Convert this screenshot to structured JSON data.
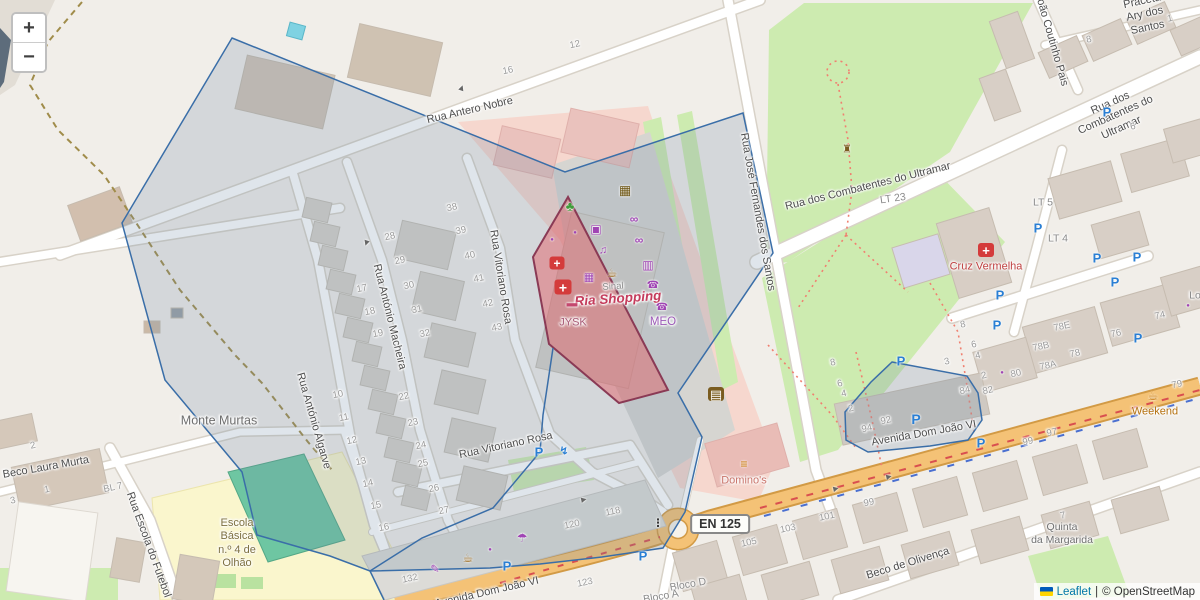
{
  "controls": {
    "zoom_in": "+",
    "zoom_out": "−"
  },
  "attribution": {
    "leaflet": "Leaflet",
    "sep": "|",
    "copyright": "© OpenStreetMap"
  },
  "en125": "EN 125",
  "colors": {
    "land": "#f1eee9",
    "road_orange": "#f4c276",
    "road_casing": "#d8d2c8",
    "green": "#cdebb0",
    "overlay_stroke": "#3a6ea8",
    "overlay_fill": "rgba(110,135,165,0.22)",
    "highlight_stroke": "#8a3a55",
    "highlight_fill": "rgba(226,100,106,0.5)",
    "shop_purple": "#a044b4",
    "health_red": "#d43b3b",
    "parking_blue": "#2a7fd4",
    "amenity_brown": "#9c6a1e"
  },
  "street_labels": [
    {
      "text": "Rua Antero Nobre",
      "x": 470,
      "y": 111,
      "r": -13,
      "s": 11
    },
    {
      "text": "Rua Vitoriano Rosa",
      "x": 500,
      "y": 277,
      "r": 81,
      "s": 11
    },
    {
      "text": "Rua Vitoriano Rosa",
      "x": 506,
      "y": 446,
      "r": -12,
      "s": 11
    },
    {
      "text": "Rua António Macheira",
      "x": 389,
      "y": 317,
      "r": 76,
      "s": 11
    },
    {
      "text": "Rua António Algarve",
      "x": 313,
      "y": 421,
      "r": 74,
      "s": 11
    },
    {
      "text": "Rua José Fernandes dos Santos",
      "x": 757,
      "y": 212,
      "r": 80,
      "s": 11
    },
    {
      "text": "Rua dos Combatentes do Ultramar",
      "x": 868,
      "y": 187,
      "r": -14,
      "s": 11
    },
    {
      "text": "Rua dos Combatentes do Ultramar",
      "x": 1116,
      "y": 116,
      "r": -24,
      "s": 11
    },
    {
      "text": "Praceta Ary dos Santos",
      "x": 1145,
      "y": 15,
      "r": -12,
      "s": 11
    },
    {
      "text": "João Coutinho Pais",
      "x": 1051,
      "y": 40,
      "r": 74,
      "s": 11
    },
    {
      "text": "Avenida Dom João VI",
      "x": 924,
      "y": 434,
      "r": -10,
      "s": 11
    },
    {
      "text": "Avenida Dom João VI",
      "x": 487,
      "y": 593,
      "r": -13,
      "s": 11
    },
    {
      "text": "Beco de Olivença",
      "x": 908,
      "y": 564,
      "r": -17,
      "s": 11
    },
    {
      "text": "Beco Laura Murta",
      "x": 46,
      "y": 468,
      "r": -10,
      "s": 11
    },
    {
      "text": "Rua Escola do Futebol",
      "x": 148,
      "y": 545,
      "r": 70,
      "s": 11
    }
  ],
  "place_labels": [
    {
      "text": "Monte Murtas",
      "x": 219,
      "y": 421,
      "r": 0,
      "s": 12.5,
      "c": "#6e6e6e"
    },
    {
      "text": "Ria Shopping",
      "x": 618,
      "y": 299,
      "r": -4,
      "s": 13.5,
      "c": "#c43c5c",
      "b": true,
      "i": true
    },
    {
      "text": "Sinal",
      "x": 613,
      "y": 287,
      "r": -4,
      "s": 9.5,
      "c": "#8a8a8a"
    },
    {
      "text": "JYSK",
      "x": 573,
      "y": 323,
      "r": 0,
      "s": 11,
      "c": "#a85a75"
    },
    {
      "text": "MEO",
      "x": 663,
      "y": 322,
      "r": 0,
      "s": 11.5,
      "c": "#9b59b6"
    },
    {
      "text": "Cruz Vermelha",
      "x": 986,
      "y": 267,
      "r": 0,
      "s": 11,
      "c": "#bf4040"
    },
    {
      "text": "Domino's",
      "x": 744,
      "y": 481,
      "r": 0,
      "s": 11,
      "c": "#c9756b"
    },
    {
      "text": "Weekend",
      "x": 1155,
      "y": 412,
      "r": 0,
      "s": 11,
      "c": "#b5710f"
    },
    {
      "text": "Escola\nBásica\nn.º 4 de\nOlhão",
      "x": 237,
      "y": 544,
      "r": 0,
      "s": 11,
      "c": "#7d7040"
    },
    {
      "text": "Quinta\nda Margarida",
      "x": 1062,
      "y": 534,
      "r": 0,
      "s": 10.5,
      "c": "#707070"
    },
    {
      "text": "Bloco D",
      "x": 688,
      "y": 585,
      "r": -10,
      "s": 10.5,
      "c": "#8a8a8a"
    },
    {
      "text": "Bloco A",
      "x": 661,
      "y": 597,
      "r": -10,
      "s": 10.5,
      "c": "#8a8a8a"
    },
    {
      "text": "LT 5",
      "x": 1043,
      "y": 203,
      "r": 0,
      "s": 10.5,
      "c": "#8a8a8a"
    },
    {
      "text": "LT 4",
      "x": 1058,
      "y": 239,
      "r": 0,
      "s": 10.5,
      "c": "#8a8a8a"
    },
    {
      "text": "LT 23",
      "x": 893,
      "y": 199,
      "r": -8,
      "s": 10.5,
      "c": "#8a8a8a"
    },
    {
      "text": "Lo",
      "x": 1195,
      "y": 296,
      "r": 0,
      "s": 10.5,
      "c": "#8a8a8a"
    }
  ],
  "house_numbers": [
    {
      "t": "10",
      "x": 338,
      "y": 395
    },
    {
      "t": "11",
      "x": 344,
      "y": 418
    },
    {
      "t": "12",
      "x": 352,
      "y": 441
    },
    {
      "t": "13",
      "x": 361,
      "y": 462
    },
    {
      "t": "14",
      "x": 368,
      "y": 484
    },
    {
      "t": "15",
      "x": 376,
      "y": 506
    },
    {
      "t": "16",
      "x": 384,
      "y": 528
    },
    {
      "t": "17",
      "x": 362,
      "y": 289
    },
    {
      "t": "18",
      "x": 370,
      "y": 312
    },
    {
      "t": "19",
      "x": 378,
      "y": 334
    },
    {
      "t": "22",
      "x": 404,
      "y": 397
    },
    {
      "t": "23",
      "x": 413,
      "y": 423
    },
    {
      "t": "24",
      "x": 421,
      "y": 446
    },
    {
      "t": "25",
      "x": 423,
      "y": 464
    },
    {
      "t": "26",
      "x": 434,
      "y": 489
    },
    {
      "t": "27",
      "x": 444,
      "y": 511
    },
    {
      "t": "28",
      "x": 390,
      "y": 237
    },
    {
      "t": "29",
      "x": 400,
      "y": 261
    },
    {
      "t": "30",
      "x": 409,
      "y": 286
    },
    {
      "t": "31",
      "x": 417,
      "y": 310
    },
    {
      "t": "32",
      "x": 425,
      "y": 334
    },
    {
      "t": "38",
      "x": 452,
      "y": 208
    },
    {
      "t": "39",
      "x": 461,
      "y": 231
    },
    {
      "t": "40",
      "x": 470,
      "y": 256
    },
    {
      "t": "41",
      "x": 479,
      "y": 279
    },
    {
      "t": "42",
      "x": 488,
      "y": 304
    },
    {
      "t": "43",
      "x": 497,
      "y": 328
    },
    {
      "t": "16",
      "x": 508,
      "y": 71
    },
    {
      "t": "12",
      "x": 575,
      "y": 45
    },
    {
      "t": "118",
      "x": 613,
      "y": 512
    },
    {
      "t": "120",
      "x": 572,
      "y": 525
    },
    {
      "t": "132",
      "x": 410,
      "y": 579
    },
    {
      "t": "123",
      "x": 585,
      "y": 583
    },
    {
      "t": "105",
      "x": 749,
      "y": 543
    },
    {
      "t": "103",
      "x": 788,
      "y": 529
    },
    {
      "t": "101",
      "x": 827,
      "y": 517
    },
    {
      "t": "99",
      "x": 869,
      "y": 503
    },
    {
      "t": "99",
      "x": 1028,
      "y": 442
    },
    {
      "t": "97",
      "x": 1052,
      "y": 433
    },
    {
      "t": "79",
      "x": 1177,
      "y": 385
    },
    {
      "t": "7",
      "x": 1063,
      "y": 516
    },
    {
      "t": "74",
      "x": 1160,
      "y": 316
    },
    {
      "t": "76",
      "x": 1116,
      "y": 334
    },
    {
      "t": "78E",
      "x": 1062,
      "y": 327
    },
    {
      "t": "78B",
      "x": 1041,
      "y": 347
    },
    {
      "t": "78",
      "x": 1075,
      "y": 354
    },
    {
      "t": "78A",
      "x": 1048,
      "y": 366
    },
    {
      "t": "80",
      "x": 1016,
      "y": 374
    },
    {
      "t": "82",
      "x": 988,
      "y": 391
    },
    {
      "t": "84",
      "x": 965,
      "y": 391
    },
    {
      "t": "92",
      "x": 886,
      "y": 421
    },
    {
      "t": "94",
      "x": 867,
      "y": 429
    },
    {
      "t": "8",
      "x": 963,
      "y": 325
    },
    {
      "t": "6",
      "x": 974,
      "y": 345
    },
    {
      "t": "4",
      "x": 978,
      "y": 356
    },
    {
      "t": "2",
      "x": 984,
      "y": 376
    },
    {
      "t": "3",
      "x": 947,
      "y": 362
    },
    {
      "t": "8",
      "x": 833,
      "y": 363
    },
    {
      "t": "6",
      "x": 840,
      "y": 384
    },
    {
      "t": "4",
      "x": 844,
      "y": 394
    },
    {
      "t": "2",
      "x": 851,
      "y": 409
    },
    {
      "t": "8",
      "x": 1089,
      "y": 40
    },
    {
      "t": "1",
      "x": 1170,
      "y": 19
    },
    {
      "t": "6",
      "x": 1133,
      "y": 127
    },
    {
      "t": "BL 7",
      "x": 113,
      "y": 488
    },
    {
      "t": "3",
      "x": 13,
      "y": 501
    },
    {
      "t": "1",
      "x": 47,
      "y": 490
    },
    {
      "t": "2",
      "x": 33,
      "y": 446
    }
  ],
  "pois": [
    {
      "name": "parking-icon",
      "g": "P",
      "x": 1107,
      "y": 112,
      "c": "#2a7fd4",
      "s": 13,
      "b": true
    },
    {
      "name": "parking-icon",
      "g": "P",
      "x": 1038,
      "y": 228,
      "c": "#2a7fd4",
      "s": 13,
      "b": true
    },
    {
      "name": "parking-icon",
      "g": "P",
      "x": 1097,
      "y": 258,
      "c": "#2a7fd4",
      "s": 13,
      "b": true
    },
    {
      "name": "parking-icon",
      "g": "P",
      "x": 1137,
      "y": 257,
      "c": "#2a7fd4",
      "s": 13,
      "b": true
    },
    {
      "name": "parking-icon",
      "g": "P",
      "x": 1115,
      "y": 282,
      "c": "#2a7fd4",
      "s": 13,
      "b": true
    },
    {
      "name": "parking-icon",
      "g": "P",
      "x": 1000,
      "y": 295,
      "c": "#2a7fd4",
      "s": 13,
      "b": true
    },
    {
      "name": "parking-icon",
      "g": "P",
      "x": 997,
      "y": 325,
      "c": "#2a7fd4",
      "s": 13,
      "b": true
    },
    {
      "name": "parking-icon",
      "g": "P",
      "x": 1138,
      "y": 338,
      "c": "#2a7fd4",
      "s": 13,
      "b": true
    },
    {
      "name": "parking-icon",
      "g": "P",
      "x": 901,
      "y": 361,
      "c": "#2a7fd4",
      "s": 13,
      "b": true
    },
    {
      "name": "parking-icon",
      "g": "P",
      "x": 916,
      "y": 419,
      "c": "#2a7fd4",
      "s": 14,
      "b": true
    },
    {
      "name": "parking-icon",
      "g": "P",
      "x": 981,
      "y": 443,
      "c": "#2a7fd4",
      "s": 13,
      "b": true
    },
    {
      "name": "parking-icon",
      "g": "P",
      "x": 539,
      "y": 452,
      "c": "#2a7fd4",
      "s": 13,
      "b": true
    },
    {
      "name": "parking-icon",
      "g": "P",
      "x": 507,
      "y": 566,
      "c": "#2a7fd4",
      "s": 13,
      "b": true
    },
    {
      "name": "parking-icon",
      "g": "P",
      "x": 643,
      "y": 556,
      "c": "#2a7fd4",
      "s": 13,
      "b": true
    },
    {
      "name": "charging-station-icon",
      "g": "↯",
      "x": 564,
      "y": 452,
      "c": "#2a7fd4",
      "s": 11,
      "b": true
    },
    {
      "name": "cinema-icon",
      "g": "▦",
      "x": 625,
      "y": 190,
      "c": "#6b5310",
      "s": 13
    },
    {
      "name": "tree-icon",
      "g": "♣",
      "x": 570,
      "y": 206,
      "c": "#3f9c3a",
      "s": 13
    },
    {
      "name": "tv-shop-icon",
      "g": "▣",
      "x": 596,
      "y": 229,
      "c": "#a044b4",
      "s": 12
    },
    {
      "name": "optician-icon",
      "g": "∞",
      "x": 634,
      "y": 219,
      "c": "#a044b4",
      "s": 12,
      "b": true
    },
    {
      "name": "optician-icon",
      "g": "∞",
      "x": 639,
      "y": 240,
      "c": "#a044b4",
      "s": 12,
      "b": true
    },
    {
      "name": "music-shop-icon",
      "g": "♫",
      "x": 603,
      "y": 251,
      "c": "#a044b4",
      "s": 11
    },
    {
      "name": "electronics-shop-icon",
      "g": "▦",
      "x": 589,
      "y": 278,
      "c": "#a044b4",
      "s": 11
    },
    {
      "name": "cafe-icon",
      "g": "☕",
      "x": 612,
      "y": 273,
      "c": "#9c6a1e",
      "s": 12
    },
    {
      "name": "supermarket-icon",
      "g": "▥",
      "x": 648,
      "y": 265,
      "c": "#a044b4",
      "s": 12
    },
    {
      "name": "phone-shop-icon",
      "g": "☎",
      "x": 653,
      "y": 286,
      "c": "#a044b4",
      "s": 10
    },
    {
      "name": "phone-shop-icon",
      "g": "☎",
      "x": 662,
      "y": 308,
      "c": "#a044b4",
      "s": 10
    },
    {
      "name": "furniture-shop-icon",
      "g": "▬",
      "x": 572,
      "y": 304,
      "c": "#c4486e",
      "s": 11
    },
    {
      "name": "pharmacy-icon",
      "g": "+",
      "x": 557,
      "y": 263,
      "bg": "#d43b3b",
      "s": 12
    },
    {
      "name": "first-aid-icon",
      "g": "+",
      "x": 563,
      "y": 287,
      "bg": "#d43b3b",
      "s": 14
    },
    {
      "name": "red-cross-icon",
      "g": "+",
      "x": 986,
      "y": 250,
      "bg": "#d43b3b",
      "s": 13
    },
    {
      "name": "kiosk-icon",
      "g": "▤",
      "x": 716,
      "y": 394,
      "bg": "#7a5c20",
      "s": 13
    },
    {
      "name": "fast-food-icon",
      "g": "≡",
      "x": 744,
      "y": 464,
      "c": "#c77400",
      "s": 12,
      "b": true
    },
    {
      "name": "cafe-icon",
      "g": "☕",
      "x": 1153,
      "y": 396,
      "c": "#c77400",
      "s": 12
    },
    {
      "name": "cafe-icon",
      "g": "☕",
      "x": 468,
      "y": 558,
      "c": "#9c6a1e",
      "s": 12
    },
    {
      "name": "umbrella-shop-icon",
      "g": "☂",
      "x": 522,
      "y": 538,
      "c": "#a044b4",
      "s": 12
    },
    {
      "name": "stationery-shop-icon",
      "g": "✎",
      "x": 435,
      "y": 570,
      "c": "#a044b4",
      "s": 11
    },
    {
      "name": "monument-icon",
      "g": "♜",
      "x": 847,
      "y": 150,
      "c": "#7a5c20",
      "s": 11
    },
    {
      "name": "traffic-light-icon",
      "g": "⋮",
      "x": 658,
      "y": 524,
      "c": "#333333",
      "s": 11,
      "b": true
    },
    {
      "name": "poi-dot",
      "g": "●",
      "x": 575,
      "y": 233,
      "c": "#a044b4",
      "s": 6
    },
    {
      "name": "poi-dot",
      "g": "●",
      "x": 552,
      "y": 240,
      "c": "#a044b4",
      "s": 6
    },
    {
      "name": "poi-dot",
      "g": "●",
      "x": 490,
      "y": 550,
      "c": "#a044b4",
      "s": 6
    },
    {
      "name": "poi-dot",
      "g": "●",
      "x": 1002,
      "y": 373,
      "c": "#a044b4",
      "s": 6
    },
    {
      "name": "poi-dot",
      "g": "●",
      "x": 1188,
      "y": 306,
      "c": "#a044b4",
      "s": 6
    },
    {
      "name": "oneway-arrow-icon",
      "g": "▶",
      "x": 462,
      "y": 88,
      "c": "#666666",
      "s": 7,
      "r": -70
    },
    {
      "name": "oneway-arrow-icon",
      "g": "▶",
      "x": 366,
      "y": 243,
      "c": "#666666",
      "s": 7,
      "r": 108
    },
    {
      "name": "oneway-arrow-icon",
      "g": "▶",
      "x": 584,
      "y": 500,
      "c": "#666666",
      "s": 7,
      "r": -12
    },
    {
      "name": "oneway-arrow-icon",
      "g": "▶",
      "x": 889,
      "y": 477,
      "c": "#666666",
      "s": 7,
      "r": -13
    },
    {
      "name": "oneway-arrow-icon",
      "g": "▶",
      "x": 836,
      "y": 489,
      "c": "#666666",
      "s": 7,
      "r": -13
    }
  ],
  "overlays": [
    {
      "name": "search-area-polygon",
      "type": "polygon",
      "points": "232,38 565,172 743,113 773,253 678,393 702,437 685,512 663,548 602,557 540,564 490,568 370,571 330,556 257,535 242,472 165,380 122,223",
      "stroke": "#3a6ea8",
      "fill": "rgba(110,135,165,0.22)",
      "width": 1.5
    },
    {
      "name": "small-area-polygon",
      "type": "polygon",
      "points": "892,362 967,376 978,393 982,420 968,440 930,446 868,452 846,440 845,412 871,382",
      "stroke": "#3a6ea8",
      "fill": "rgba(110,135,165,0.22)",
      "width": 1.5
    },
    {
      "name": "highlight-area-polygon",
      "type": "polygon",
      "points": "568,197 533,257 549,344 619,403 668,390",
      "stroke": "#8a3a55",
      "fill": "rgba(226,100,106,0.5)",
      "width": 2
    },
    {
      "name": "boundary-line",
      "type": "polyline",
      "points": "553,348 543,415 540,452 493,508 422,538 370,571 384,600",
      "stroke": "#3a6ea8",
      "fill": "none",
      "width": 1.5
    }
  ]
}
